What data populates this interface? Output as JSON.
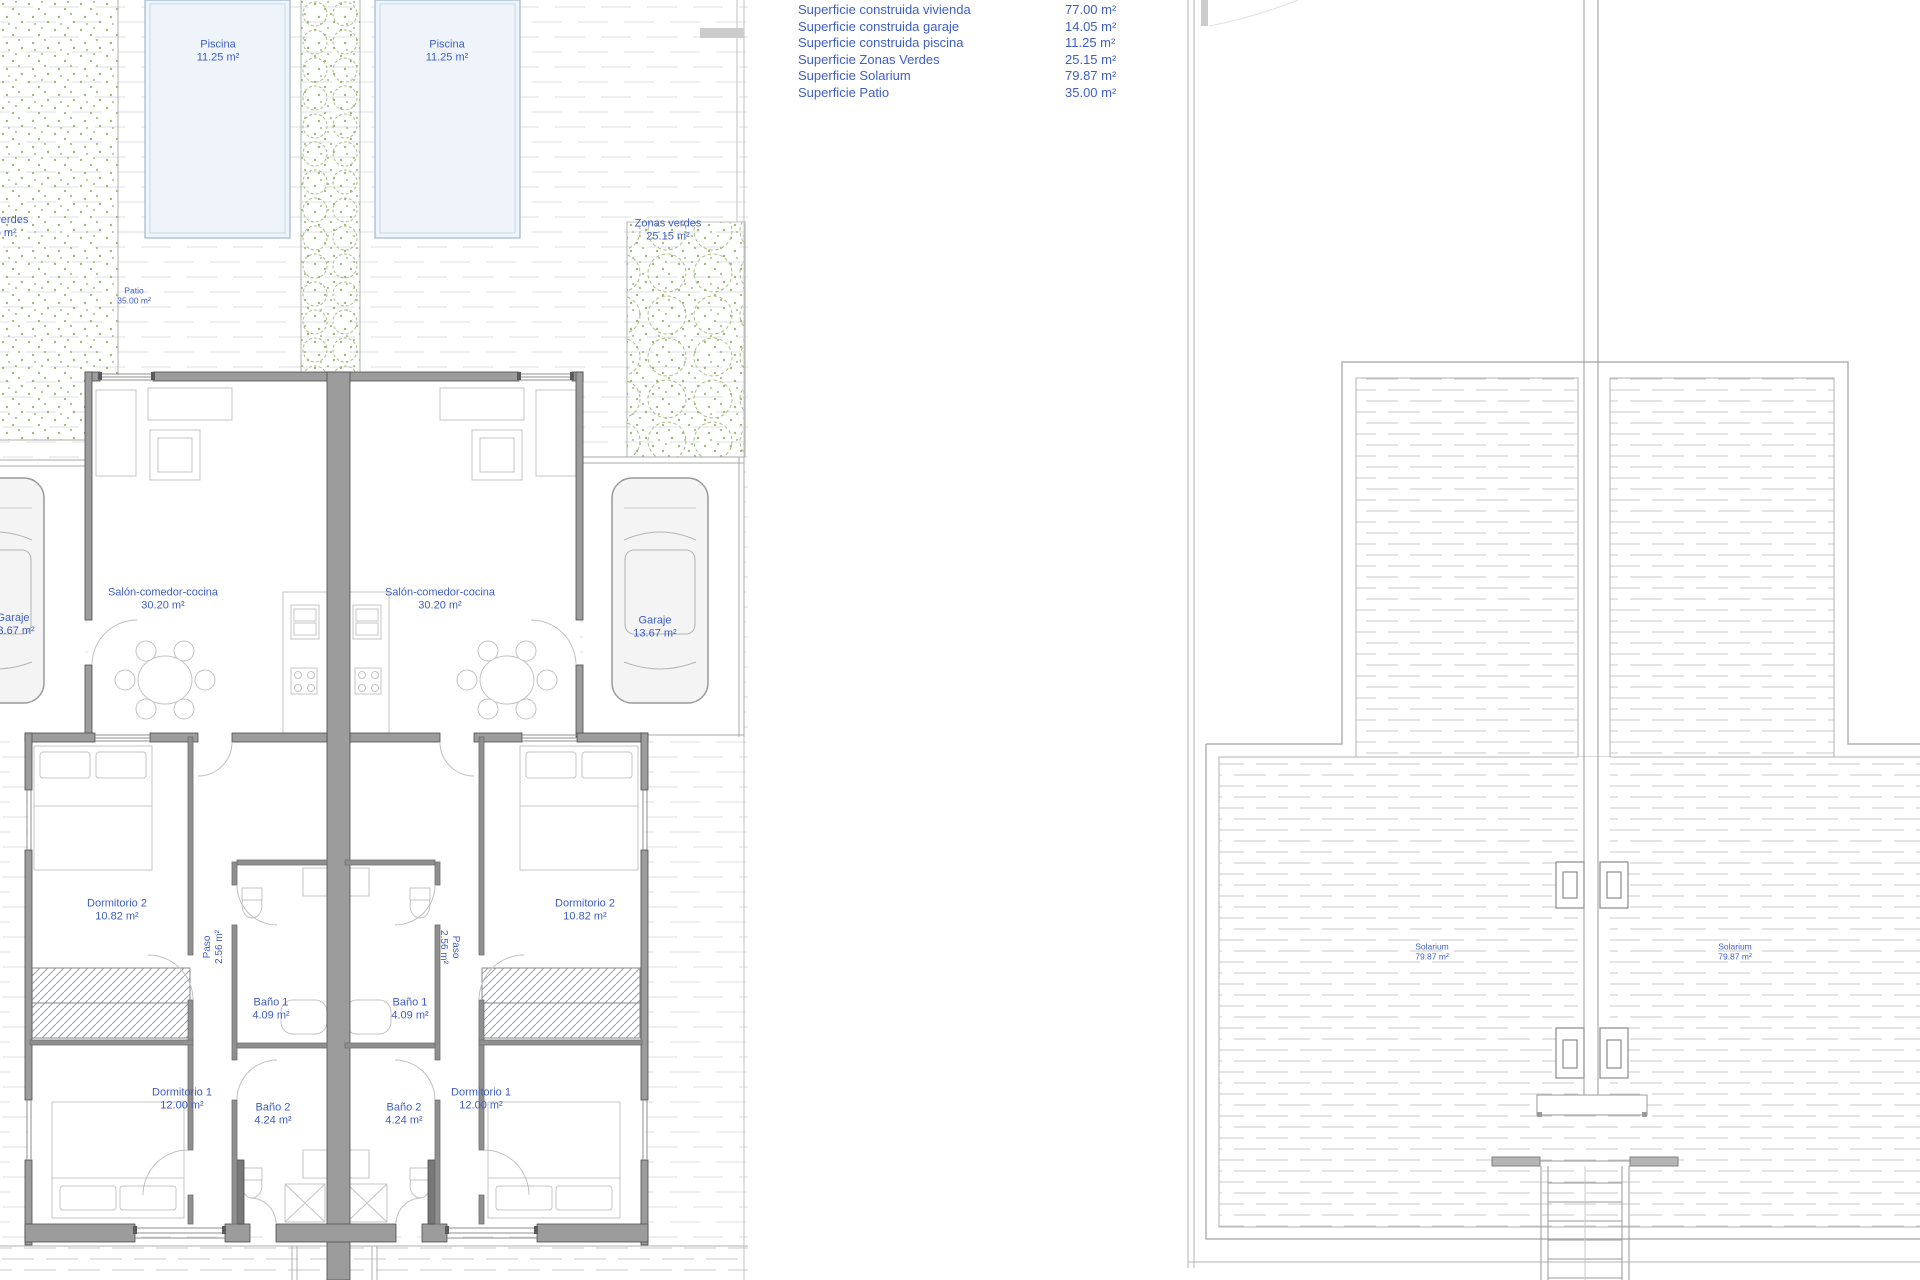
{
  "legend": {
    "rows": [
      {
        "label": "Superficie construida vivienda",
        "value": "77.00 m²"
      },
      {
        "label": "Superficie construida garaje",
        "value": "14.05 m²"
      },
      {
        "label": "Superficie construida piscina",
        "value": "11.25 m²"
      },
      {
        "label": "Superficie Zonas Verdes",
        "value": "25.15 m²"
      },
      {
        "label": "Superficie Solarium",
        "value": "79.87 m²"
      },
      {
        "label": "Superficie Patio",
        "value": "35.00 m²"
      }
    ]
  },
  "plan_left": {
    "piscina": {
      "name": "Piscina",
      "area": "11.25 m²"
    },
    "zonas_verdes": {
      "name": "Zonas verdes",
      "area": "25.15 m²"
    },
    "patio": {
      "name": "Patio",
      "area": "35.00 m²"
    },
    "salon": {
      "name": "Salón-comedor-cocina",
      "area": "30.20 m²"
    },
    "garaje": {
      "name": "Garaje",
      "area": "13.67 m²"
    },
    "dormitorio2": {
      "name": "Dormitorio 2",
      "area": "10.82 m²"
    },
    "paso": {
      "name": "Paso",
      "area": "2.56 m²"
    },
    "bano1": {
      "name": "Baño 1",
      "area": "4.09 m²"
    },
    "bano2": {
      "name": "Baño 2",
      "area": "4.24 m²"
    },
    "dormitorio1": {
      "name": "Dormitorio 1",
      "area": "12.00 m²"
    }
  },
  "plan_right": {
    "solarium": {
      "name": "Solarium",
      "area": "79.87 m²"
    }
  },
  "colors": {
    "annotation_blue": "#3e5ec7",
    "wall_gray": "#9c9c9c",
    "green_speckle": "#a3b877",
    "pool_blue": "#eef4fa",
    "hatch_gray": "#c6c9cc"
  }
}
